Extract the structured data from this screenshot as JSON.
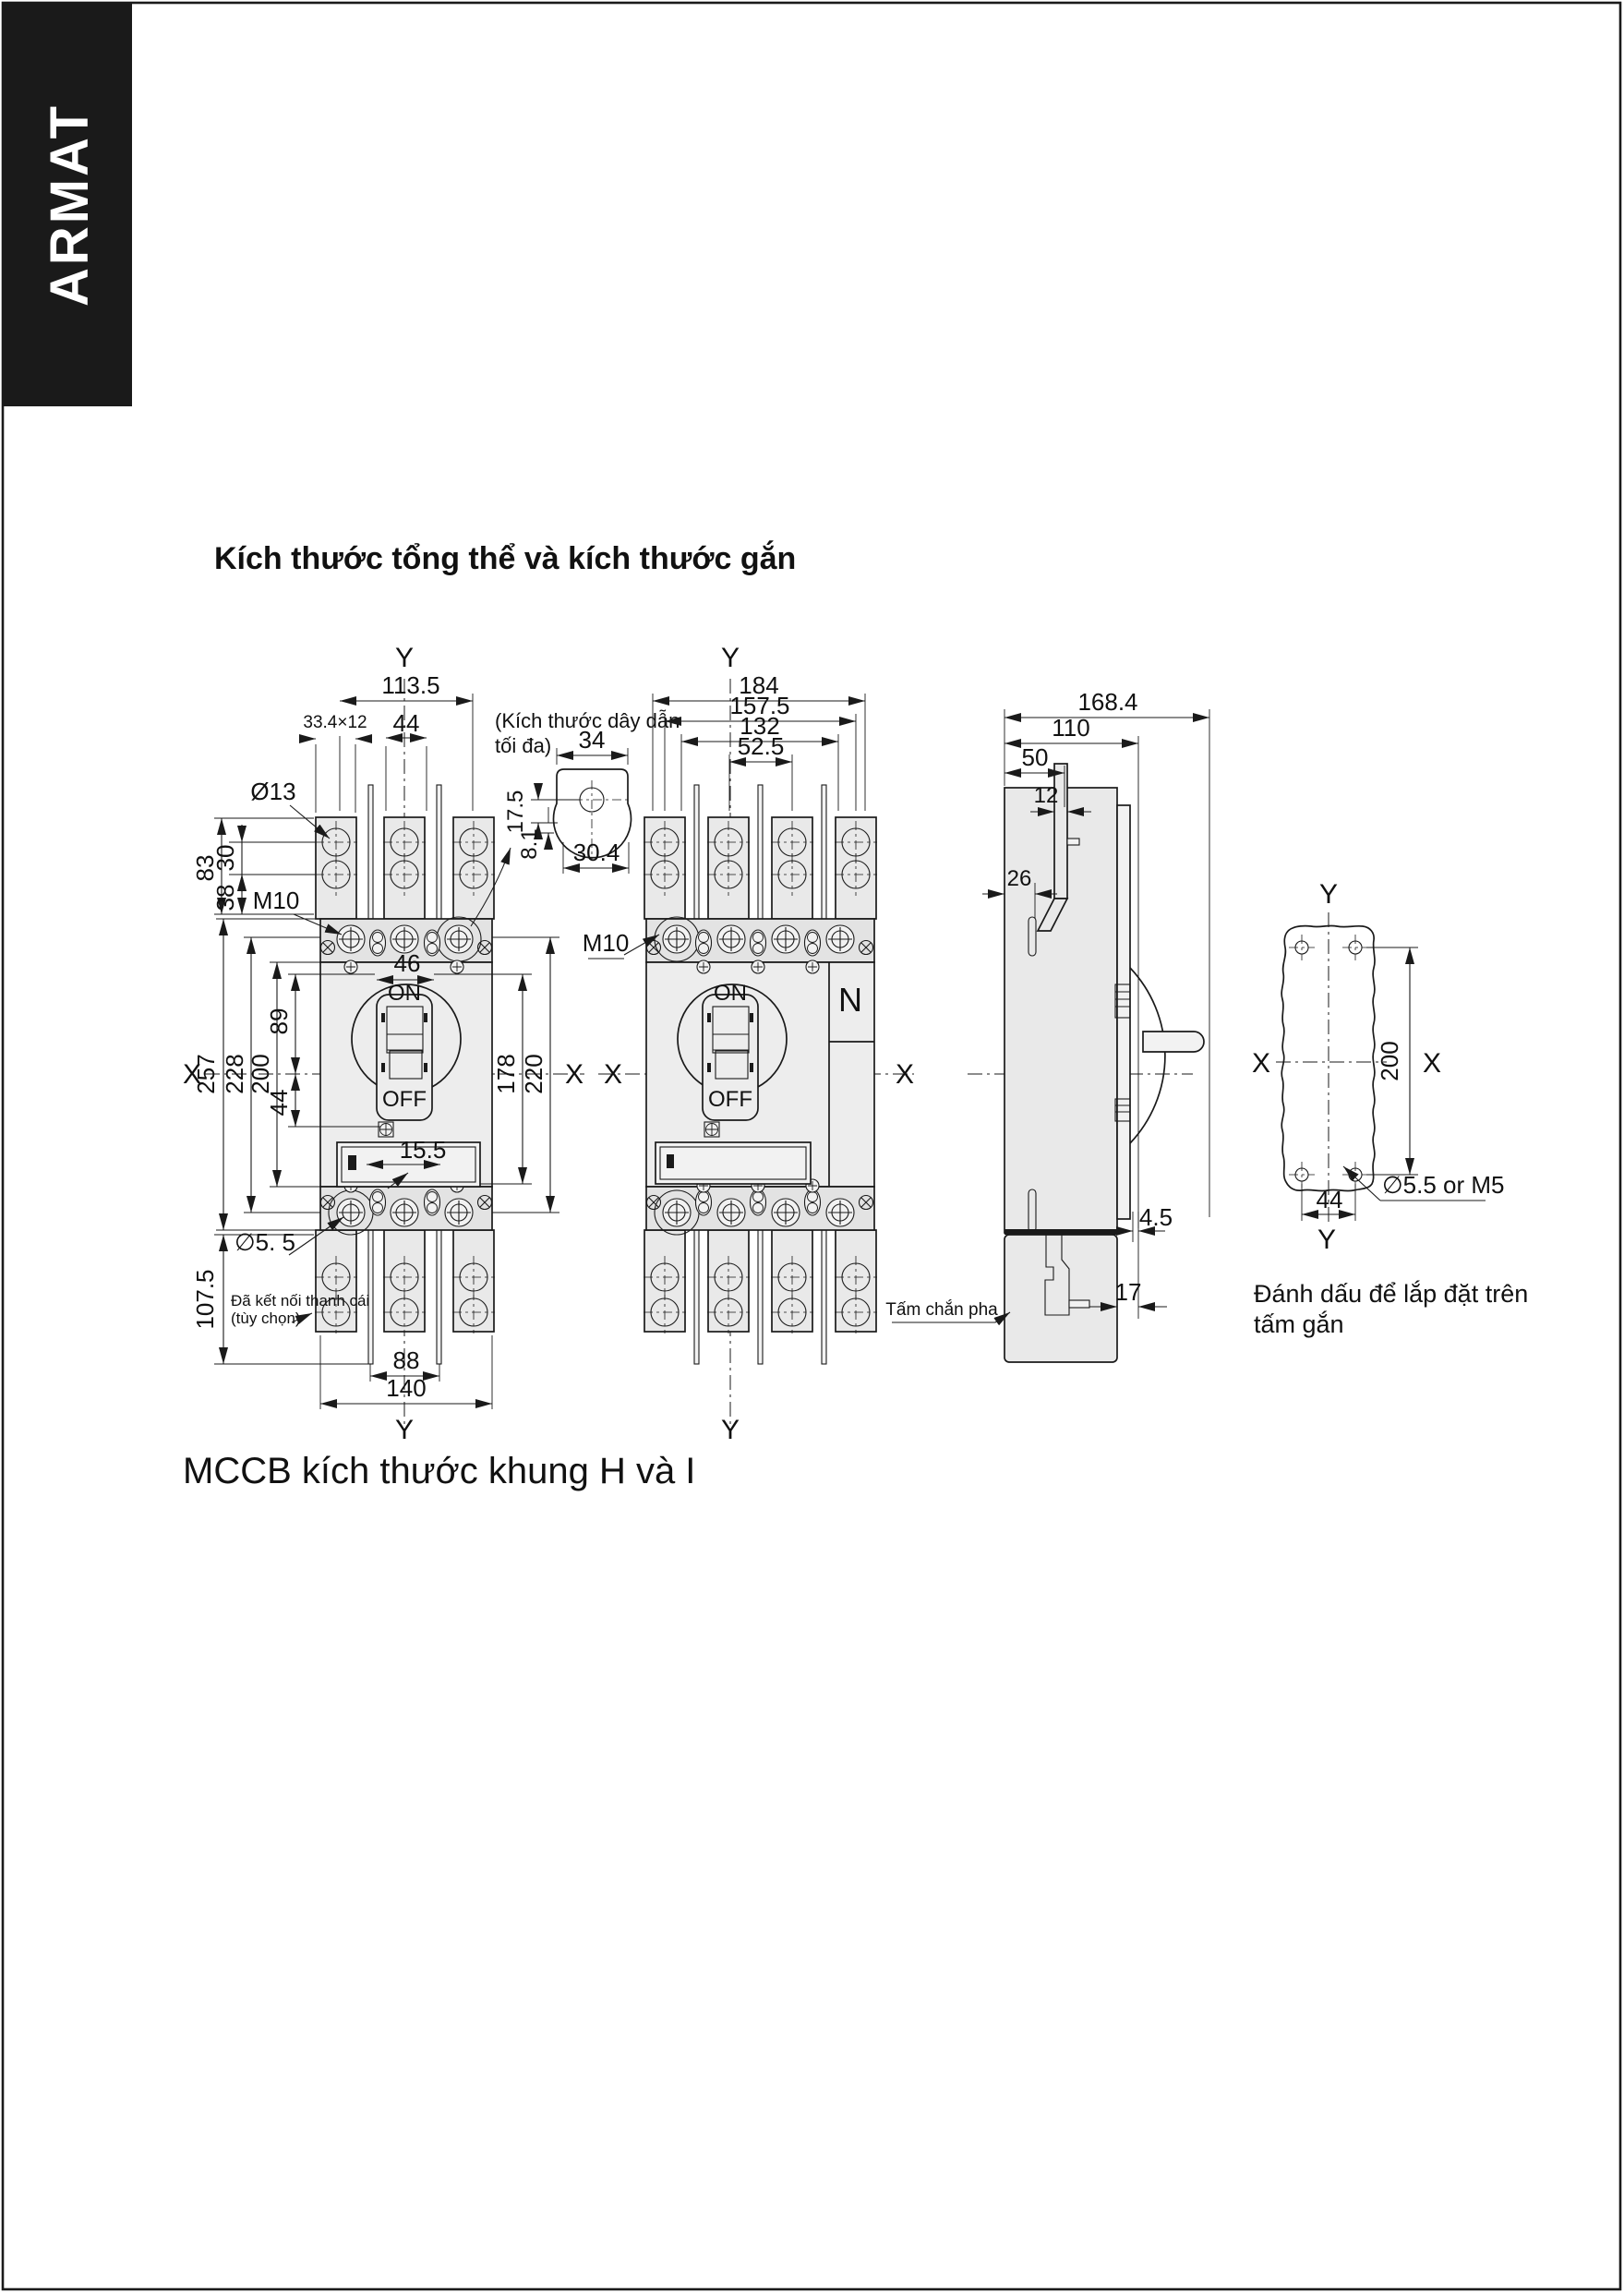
{
  "page": {
    "brand": "ARMAT",
    "title": "Kích thước tổng thể và kích thước gắn",
    "caption": "MCCB kích thước khung H và I"
  },
  "axes": {
    "x": "X",
    "y": "Y"
  },
  "sw": {
    "on": "ON",
    "off": "OFF"
  },
  "front3p": {
    "w_overall": "113.5",
    "pole_pitch": "44",
    "lug_section": "33.4×12",
    "lug_hole": "Ø13",
    "h83": "83",
    "h30": "30",
    "h38": "38",
    "thread": "M10",
    "handle_w": "46",
    "h89": "89",
    "h257": "257",
    "h228": "228",
    "h200": "200",
    "h44": "44",
    "h178": "178",
    "h220": "220",
    "w155": "15.5",
    "mount_hole": "∅5. 5",
    "h1075": "107.5",
    "w88": "88",
    "w140": "140",
    "busbar1": "Đã kết nối thanh cái",
    "busbar2": "(tùy chọn)"
  },
  "detail": {
    "note1": "(Kích thước dây dẫn",
    "note2": "tối đa)",
    "w34": "34",
    "h175": "17.5",
    "h81": "8.1",
    "w304": "30.4"
  },
  "front4p": {
    "w184": "184",
    "w1575": "157.5",
    "w132": "132",
    "w525": "52.5",
    "thread": "M10",
    "neutral": "N"
  },
  "side": {
    "d1684": "168.4",
    "d110": "110",
    "d50": "50",
    "d12": "12",
    "d26": "26",
    "d45": "4.5",
    "d17": "17",
    "phase": "Tấm chắn pha"
  },
  "plate": {
    "h200": "200",
    "w44": "44",
    "hole": "∅5.5 or M5",
    "cap1": "Đánh dấu để lắp đặt trên",
    "cap2": "tấm gắn"
  }
}
